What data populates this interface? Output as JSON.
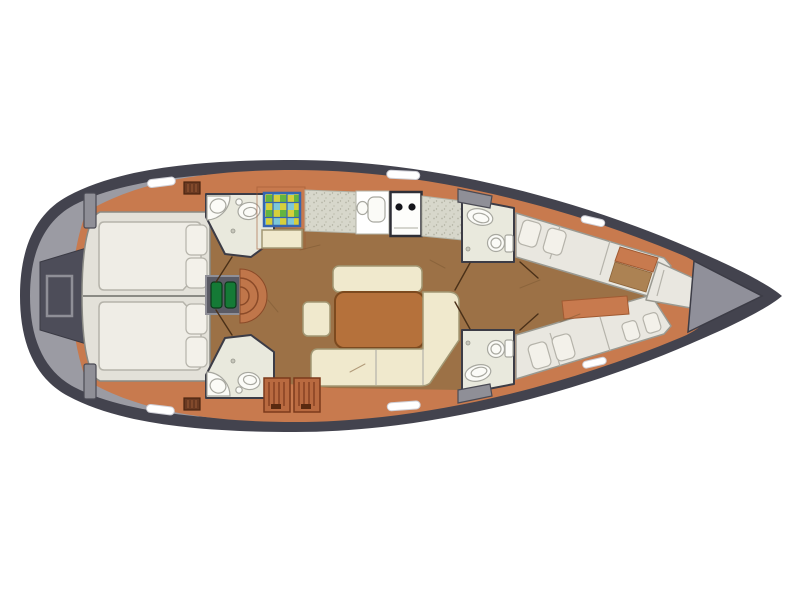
{
  "plan": {
    "type": "sailboat-interior-floor-plan",
    "orientation": "bow-right",
    "rooms": [
      "aft-deck-cockpit",
      "aft-cabin-twin-double-berths",
      "head-port-aft",
      "head-starboard-aft",
      "companionway-stairs",
      "galley",
      "salon",
      "head-port-forward",
      "head-starboard-forward",
      "forward-cabin-v-berths",
      "foredeck-anchor-locker"
    ],
    "fixtures": [
      "transom-gate",
      "sink",
      "toilet",
      "stove-two-burner",
      "galley-sink",
      "colored-grid-hatch",
      "deck-hatch",
      "winch-pad",
      "vent-grate",
      "louvered-locker",
      "salon-table",
      "settee",
      "l-shaped-sofa",
      "stool"
    ]
  },
  "palette": {
    "background": "#ffffff",
    "hull_dark": "#43434e",
    "deck_gray": "#9b9ba3",
    "cockpit_gray": "#4d4d59",
    "foredeck_gray": "#90909a",
    "trim_orange": "#c87a4e",
    "stair_orange": "#c0764a",
    "floor_brown": "#9c7146",
    "floor_tan": "#ac8253",
    "bed_base": "#e3e1d9",
    "mattress_white": "#efede6",
    "cream": "#f0e9cd",
    "table_brown": "#b5713b",
    "bath_floor": "#e9e9dd",
    "fixture_white": "#fbfbf7",
    "counter_speckle": "#d7d7cb",
    "stove_white": "#fdfdfb",
    "step_green": "#157a36",
    "grid_blue": "#3565b0",
    "grid_green": "#63b53f",
    "grid_yellow": "#d6cf3c",
    "hatch_white": "#ffffff",
    "wall_dark": "#3c3c46",
    "louver_orange": "#b96a40"
  }
}
